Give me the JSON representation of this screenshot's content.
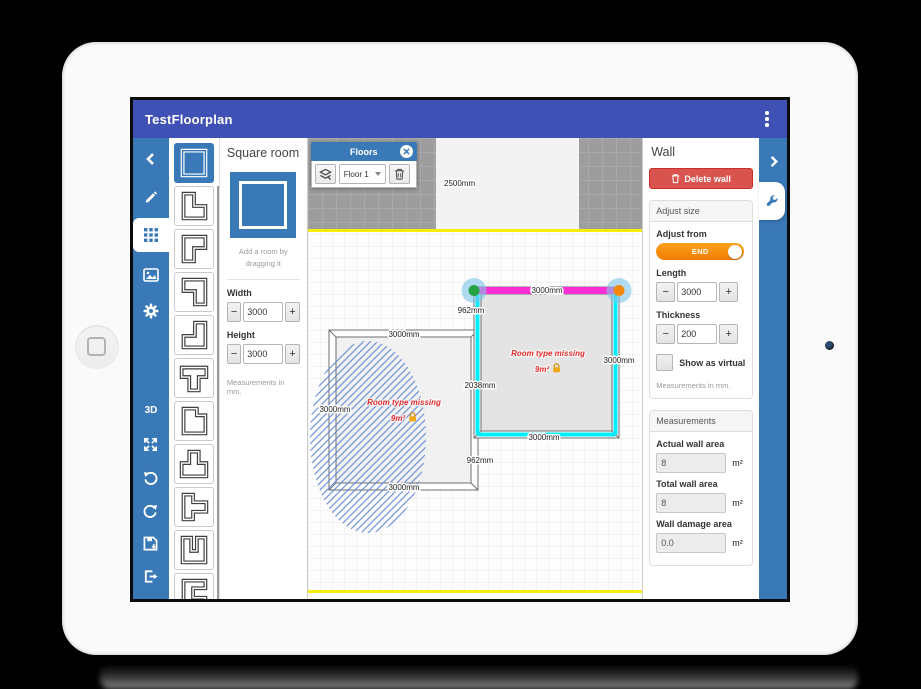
{
  "app": {
    "title": "TestFloorplan",
    "colors": {
      "appbar": "#3f51b5",
      "toolbar_blue": "#3a79b8",
      "delete_red": "#d9534f",
      "toggle_orange": "#f38c07",
      "selected_wall_magenta": "#ff2fd6",
      "highlight_cyan": "#00eeff",
      "endpoint_green": "#25a244",
      "endpoint_orange": "#f2880a",
      "floor_bound_yellow": "#f6ee0a"
    }
  },
  "left_toolbar": {
    "items": [
      {
        "name": "collapse-left",
        "icon": "chevron-left-icon"
      },
      {
        "name": "draw",
        "icon": "pencil-icon"
      },
      {
        "name": "rooms",
        "icon": "rooms-grid-icon",
        "active": true
      },
      {
        "name": "background-image",
        "icon": "image-icon"
      },
      {
        "name": "settings",
        "icon": "gear-icon"
      },
      {
        "name": "view-3d",
        "label": "3D"
      },
      {
        "name": "fullscreen",
        "icon": "expand-icon"
      },
      {
        "name": "undo",
        "icon": "undo-icon"
      },
      {
        "name": "redo",
        "icon": "redo-icon"
      },
      {
        "name": "save",
        "icon": "save-icon"
      },
      {
        "name": "exit",
        "icon": "exit-icon"
      }
    ]
  },
  "shape_palette": {
    "selected": "square",
    "shapes": [
      "square",
      "l-bottom-left",
      "l-top-left",
      "l-top-right",
      "l-bottom-right",
      "t-down",
      "l-notch",
      "t-up",
      "t-right",
      "u-up",
      "e-right",
      "u-down"
    ]
  },
  "room_panel": {
    "title": "Square room",
    "hint": "Add a room by dragging it",
    "width_label": "Width",
    "width_value": "3000",
    "height_label": "Height",
    "height_value": "3000",
    "minus": "−",
    "plus": "+",
    "note": "Measurements in mm."
  },
  "floors_panel": {
    "title": "Floors",
    "floor_select_value": "Floor 1",
    "icons": [
      "layers-icon",
      "close-icon",
      "trash-icon",
      "caret-down-icon"
    ]
  },
  "canvas": {
    "outside_label": "2500mm",
    "dimension_labels": [
      {
        "text": "3000mm"
      },
      {
        "text": "962mm"
      },
      {
        "text": "2038mm"
      },
      {
        "text": "962mm"
      },
      {
        "text": "3000mm"
      },
      {
        "text": "3000mm"
      },
      {
        "text": "3000mm"
      },
      {
        "text": "3000mm"
      },
      {
        "text": "3000mm"
      }
    ],
    "rooms": [
      {
        "type_text": "Room type missing",
        "area": "9m²"
      },
      {
        "type_text": "Room type missing",
        "area": "9m²"
      }
    ]
  },
  "wall_panel": {
    "title": "Wall",
    "delete_button": "Delete wall",
    "adjust_size_header": "Adjust size",
    "adjust_from_label": "Adjust from",
    "adjust_from_value": "END",
    "length_label": "Length",
    "length_value": "3000",
    "thickness_label": "Thickness",
    "thickness_value": "200",
    "minus": "−",
    "plus": "+",
    "virtual_label": "Show as virtual",
    "note": "Measurements in mm.",
    "measurements_header": "Measurements",
    "fields": [
      {
        "label": "Actual wall area",
        "value": "8",
        "unit": "m²"
      },
      {
        "label": "Total wall area",
        "value": "8",
        "unit": "m²"
      },
      {
        "label": "Wall damage area",
        "value": "0.0",
        "unit": "m²"
      }
    ]
  }
}
